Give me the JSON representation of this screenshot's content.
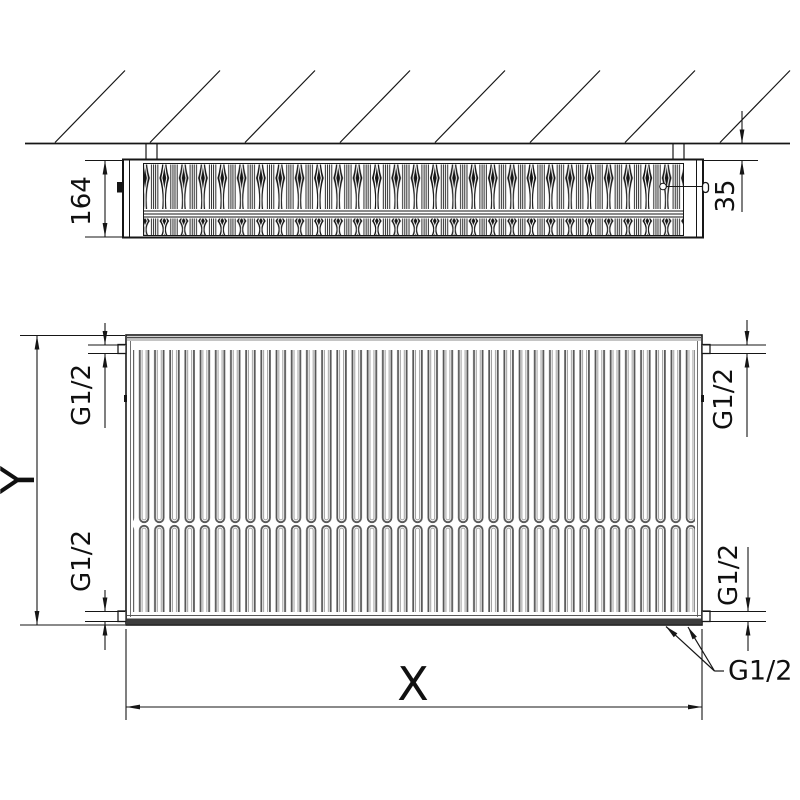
{
  "top_view": {
    "depth_dimension": "164",
    "wall_clearance_dimension": "35"
  },
  "front_view": {
    "width_dimension": "X",
    "height_dimension": "Y",
    "thread_top_left": "G1/2",
    "thread_top_right": "G1/2",
    "thread_bottom_left": "G1/2",
    "thread_bottom_right": "G1/2",
    "thread_bottom_center": "G1/2"
  }
}
